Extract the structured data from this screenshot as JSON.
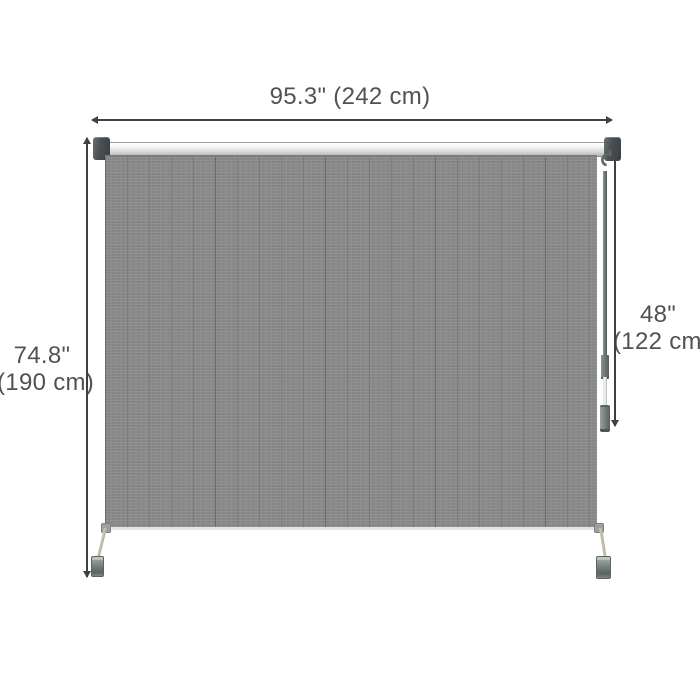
{
  "figure": {
    "type": "product-dimension-diagram",
    "product": "outdoor roller shade blind with hand crank and floor clamps",
    "background": "#ffffff"
  },
  "dimensions": {
    "width": {
      "full": "95.3\" (242 cm)",
      "inches": "95.3\"",
      "metric": "(242 cm)"
    },
    "height": {
      "inches": "74.8\"",
      "metric": "(190 cm)"
    },
    "crank_length": {
      "inches": "48\"",
      "metric": "(122 cm)"
    }
  },
  "colors": {
    "fabric": "#8b8b8b",
    "fabric_stripe": "#7b7b7b",
    "roller_bar_light": "#f7f7f7",
    "roller_bar_dark": "#b2b5b6",
    "end_cap": "#454b4e",
    "crank": "#6a736f",
    "leg": "#c9c0ab",
    "clamp": "#6f7977",
    "dimension_line": "#3f3f3f",
    "label_text": "#525252"
  }
}
